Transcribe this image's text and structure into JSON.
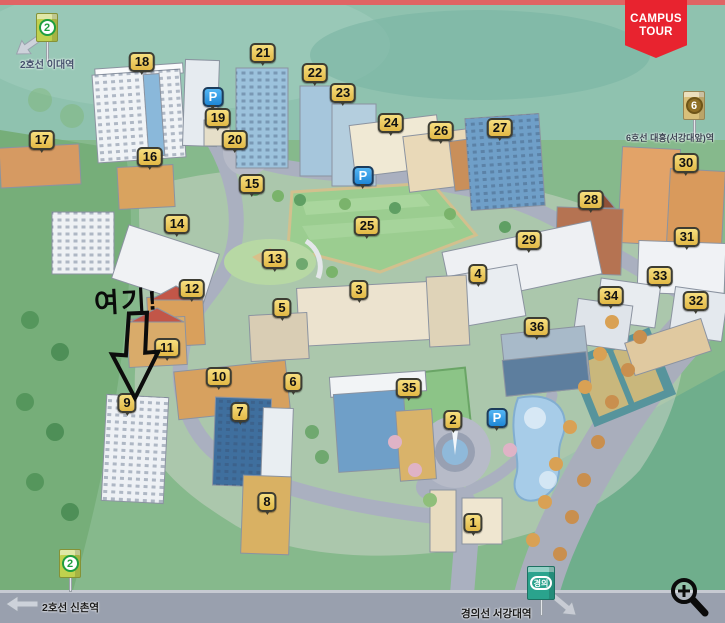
{
  "badge": {
    "line1": "CAMPUS",
    "line2": "TOUR",
    "bg_color": "#e8232f",
    "text_color": "#ffffff"
  },
  "annotation": {
    "text": "여기!",
    "points_to_marker": "9"
  },
  "stations": {
    "line2_ewha": {
      "badge": "2",
      "label": "2호선 이대역",
      "line_color": "#1f9e3f"
    },
    "line6_daeheung": {
      "badge": "6",
      "label": "6호선 대흥(서강대앞)역",
      "line_color": "#8f6f26"
    },
    "line2_sinchon": {
      "badge": "2",
      "label": "2호선 신촌역",
      "line_color": "#1f9e3f"
    },
    "gyeongui_sogang": {
      "badge": "경의",
      "label": "경의선 서강대역",
      "line_color": "#2aa38d"
    }
  },
  "map": {
    "marker_style": {
      "bg": "#eec95c",
      "border": "#3d3d33",
      "text": "#111111"
    },
    "parking_style": {
      "label": "P",
      "bg": "#2e9fe8",
      "text": "#ffffff"
    },
    "building_markers": [
      {
        "n": "1",
        "x": 473,
        "y": 523
      },
      {
        "n": "2",
        "x": 453,
        "y": 420
      },
      {
        "n": "3",
        "x": 359,
        "y": 290
      },
      {
        "n": "4",
        "x": 478,
        "y": 274
      },
      {
        "n": "5",
        "x": 282,
        "y": 308
      },
      {
        "n": "6",
        "x": 293,
        "y": 382
      },
      {
        "n": "7",
        "x": 240,
        "y": 412
      },
      {
        "n": "8",
        "x": 267,
        "y": 502
      },
      {
        "n": "9",
        "x": 127,
        "y": 403
      },
      {
        "n": "10",
        "x": 219,
        "y": 377
      },
      {
        "n": "11",
        "x": 167,
        "y": 348
      },
      {
        "n": "12",
        "x": 192,
        "y": 289
      },
      {
        "n": "13",
        "x": 275,
        "y": 259
      },
      {
        "n": "14",
        "x": 177,
        "y": 224
      },
      {
        "n": "15",
        "x": 252,
        "y": 184
      },
      {
        "n": "16",
        "x": 150,
        "y": 157
      },
      {
        "n": "17",
        "x": 42,
        "y": 140
      },
      {
        "n": "18",
        "x": 142,
        "y": 62
      },
      {
        "n": "19",
        "x": 218,
        "y": 118
      },
      {
        "n": "20",
        "x": 235,
        "y": 140
      },
      {
        "n": "21",
        "x": 263,
        "y": 53
      },
      {
        "n": "22",
        "x": 315,
        "y": 73
      },
      {
        "n": "23",
        "x": 343,
        "y": 93
      },
      {
        "n": "24",
        "x": 391,
        "y": 123
      },
      {
        "n": "25",
        "x": 367,
        "y": 226
      },
      {
        "n": "26",
        "x": 441,
        "y": 131
      },
      {
        "n": "27",
        "x": 500,
        "y": 128
      },
      {
        "n": "28",
        "x": 591,
        "y": 200
      },
      {
        "n": "29",
        "x": 529,
        "y": 240
      },
      {
        "n": "30",
        "x": 686,
        "y": 163
      },
      {
        "n": "31",
        "x": 687,
        "y": 237
      },
      {
        "n": "32",
        "x": 696,
        "y": 301
      },
      {
        "n": "33",
        "x": 660,
        "y": 276
      },
      {
        "n": "34",
        "x": 611,
        "y": 296
      },
      {
        "n": "35",
        "x": 409,
        "y": 388
      },
      {
        "n": "36",
        "x": 537,
        "y": 327
      }
    ],
    "parking_markers": [
      {
        "x": 213,
        "y": 97
      },
      {
        "x": 363,
        "y": 176
      },
      {
        "x": 497,
        "y": 418
      }
    ]
  },
  "controls": {
    "zoom_in": {
      "name": "zoom-in-magnifier"
    }
  }
}
